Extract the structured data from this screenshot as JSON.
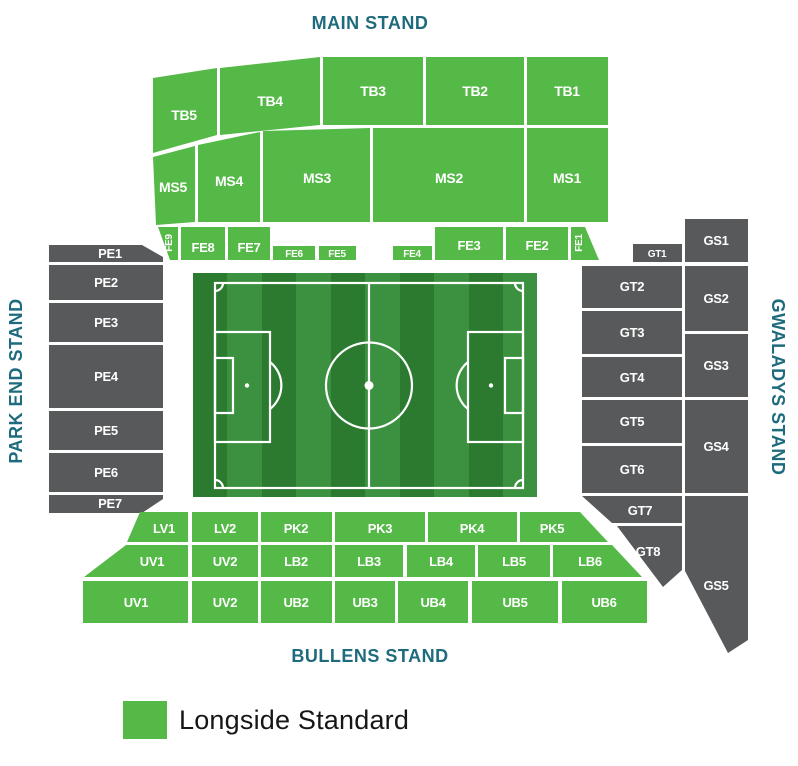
{
  "stands": {
    "main": {
      "label": "MAIN STAND"
    },
    "park_end": {
      "label": "PARK END STAND"
    },
    "gwaladys": {
      "label": "GWALADYS STAND"
    },
    "bullens": {
      "label": "BULLENS STAND"
    }
  },
  "sections": {
    "TB1": "TB1",
    "TB2": "TB2",
    "TB3": "TB3",
    "TB4": "TB4",
    "TB5": "TB5",
    "MS1": "MS1",
    "MS2": "MS2",
    "MS3": "MS3",
    "MS4": "MS4",
    "MS5": "MS5",
    "FE1": "FE1",
    "FE2": "FE2",
    "FE3": "FE3",
    "FE4": "FE4",
    "FE5": "FE5",
    "FE6": "FE6",
    "FE7": "FE7",
    "FE8": "FE8",
    "FE9": "FE9",
    "PE1": "PE1",
    "PE2": "PE2",
    "PE3": "PE3",
    "PE4": "PE4",
    "PE5": "PE5",
    "PE6": "PE6",
    "PE7": "PE7",
    "GT1": "GT1",
    "GT2": "GT2",
    "GT3": "GT3",
    "GT4": "GT4",
    "GT5": "GT5",
    "GT6": "GT6",
    "GT7": "GT7",
    "GT8": "GT8",
    "GS1": "GS1",
    "GS2": "GS2",
    "GS3": "GS3",
    "GS4": "GS4",
    "GS5": "GS5",
    "LV1": "LV1",
    "LV2": "LV2",
    "PK2": "PK2",
    "PK3": "PK3",
    "PK4": "PK4",
    "PK5": "PK5",
    "UV1": "UV1",
    "UV2": "UV2",
    "LB2": "LB2",
    "LB3": "LB3",
    "LB4": "LB4",
    "LB5": "LB5",
    "LB6": "LB6",
    "UB2": "UB2",
    "UB3": "UB3",
    "UB4": "UB4",
    "UB5": "UB5",
    "UB6": "UB6"
  },
  "legend": {
    "items": [
      {
        "label": "Longside Standard",
        "color": "#55b948",
        "status": "available"
      }
    ]
  },
  "colors": {
    "available": "#55b948",
    "unavailable": "#58595b",
    "stand_label_text": "#1e6b7d"
  }
}
